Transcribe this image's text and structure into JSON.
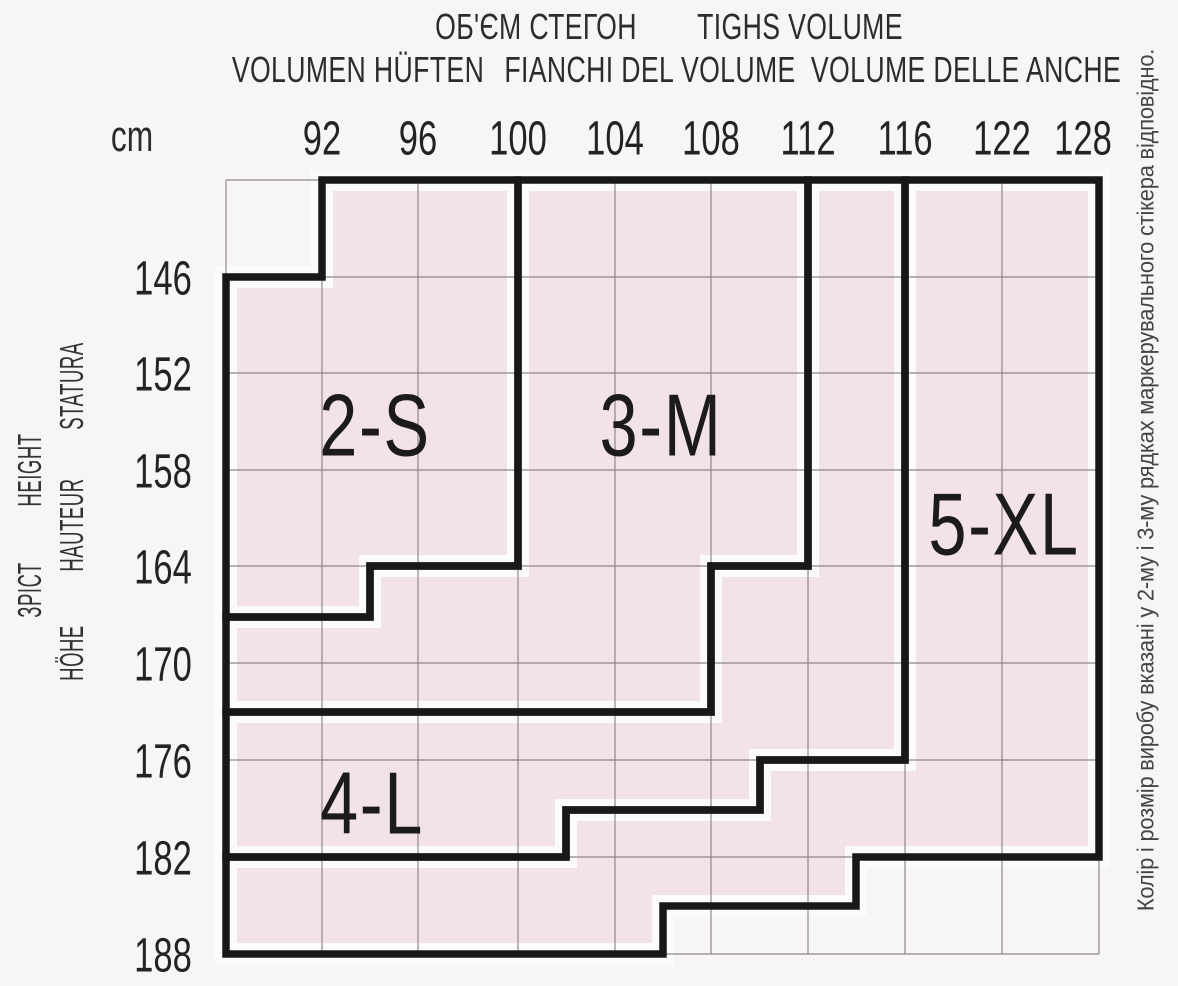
{
  "header": {
    "row1": [
      "ОБ'ЄМ СТЕГОН",
      "TIGHS VOLUME"
    ],
    "row2": [
      "VOLUMEN HÜFTEN",
      "FIANCHI DEL VOLUME",
      "VOLUME DELLE ANCHE"
    ],
    "unit_label": "cm"
  },
  "left_axis_titles": [
    "STATURA",
    "HEIGHT",
    "HAUTEUR",
    "ЗРІСТ",
    "HÖHE"
  ],
  "side_note": "Колір і розмір виробу вказані у 2-му і 3-му рядках маркерувального стікера відповідно.",
  "chart_data": {
    "type": "area",
    "title": "ОБ'ЄМ СТЕГОН / TIGHS VOLUME — hosiery size regions",
    "xlabel": "hip volume, cm",
    "ylabel": "height (зріст), cm",
    "x_ticks": [
      "92",
      "96",
      "100",
      "104",
      "108",
      "112",
      "116",
      "122",
      "128"
    ],
    "y_ticks": [
      "146",
      "152",
      "158",
      "164",
      "170",
      "176",
      "182",
      "188"
    ],
    "grid": true,
    "legend_position": "none",
    "units_note": "polygon_units are [hip_cm, height_cm]; 88 and 140 stand for the unlabeled left/top chart borders; half-step values (94,102,106,110,114 / 167,173,179,185) are mid-cell boundary steps",
    "grid_x_px": [
      226,
      322,
      418,
      518,
      615,
      711,
      808,
      905,
      1002,
      1099
    ],
    "grid_y_px": [
      180,
      277,
      373,
      470,
      566,
      663,
      760,
      857,
      954
    ],
    "x_tick_label_px": [
      322,
      418,
      518,
      615,
      711,
      808,
      905,
      1002,
      1083
    ],
    "y_tick_label_px": [
      277,
      373,
      470,
      566,
      663,
      760,
      857,
      954
    ],
    "regions": [
      {
        "label": "2-S",
        "label_px": [
          375,
          424
        ],
        "polygon_px": [
          [
            322,
            180
          ],
          [
            518,
            180
          ],
          [
            518,
            566
          ],
          [
            370,
            566
          ],
          [
            370,
            617
          ],
          [
            226,
            617
          ],
          [
            226,
            277
          ],
          [
            322,
            277
          ]
        ],
        "polygon_units": [
          [
            92,
            140
          ],
          [
            100,
            140
          ],
          [
            100,
            164
          ],
          [
            94,
            164
          ],
          [
            94,
            167
          ],
          [
            88,
            167
          ],
          [
            88,
            146
          ],
          [
            92,
            146
          ]
        ]
      },
      {
        "label": "3-M",
        "label_px": [
          661,
          424
        ],
        "polygon_px": [
          [
            518,
            180
          ],
          [
            808,
            180
          ],
          [
            808,
            566
          ],
          [
            711,
            566
          ],
          [
            711,
            712
          ],
          [
            226,
            712
          ],
          [
            226,
            617
          ],
          [
            370,
            617
          ],
          [
            370,
            566
          ],
          [
            518,
            566
          ]
        ],
        "polygon_units": [
          [
            100,
            140
          ],
          [
            112,
            140
          ],
          [
            112,
            164
          ],
          [
            108,
            164
          ],
          [
            108,
            173
          ],
          [
            88,
            173
          ],
          [
            88,
            167
          ],
          [
            94,
            167
          ],
          [
            94,
            164
          ],
          [
            100,
            164
          ]
        ]
      },
      {
        "label": "4-L",
        "label_px": [
          372,
          802
        ],
        "polygon_px": [
          [
            808,
            180
          ],
          [
            905,
            180
          ],
          [
            905,
            760
          ],
          [
            760,
            760
          ],
          [
            760,
            810
          ],
          [
            566,
            810
          ],
          [
            566,
            857
          ],
          [
            226,
            857
          ],
          [
            226,
            712
          ],
          [
            711,
            712
          ],
          [
            711,
            566
          ],
          [
            808,
            566
          ]
        ],
        "polygon_units": [
          [
            112,
            140
          ],
          [
            116,
            140
          ],
          [
            116,
            176
          ],
          [
            110,
            176
          ],
          [
            110,
            179
          ],
          [
            102,
            179
          ],
          [
            102,
            182
          ],
          [
            88,
            182
          ],
          [
            88,
            173
          ],
          [
            108,
            173
          ],
          [
            108,
            164
          ],
          [
            112,
            164
          ]
        ]
      },
      {
        "label": "5-XL",
        "label_px": [
          1004,
          523
        ],
        "polygon_px": [
          [
            905,
            180
          ],
          [
            1099,
            180
          ],
          [
            1099,
            857
          ],
          [
            856,
            857
          ],
          [
            856,
            906
          ],
          [
            663,
            906
          ],
          [
            663,
            954
          ],
          [
            226,
            954
          ],
          [
            226,
            857
          ],
          [
            566,
            857
          ],
          [
            566,
            810
          ],
          [
            760,
            810
          ],
          [
            760,
            760
          ],
          [
            905,
            760
          ]
        ],
        "polygon_units": [
          [
            116,
            140
          ],
          [
            128,
            140
          ],
          [
            128,
            182
          ],
          [
            114,
            182
          ],
          [
            114,
            185
          ],
          [
            106,
            185
          ],
          [
            106,
            188
          ],
          [
            88,
            188
          ],
          [
            88,
            182
          ],
          [
            102,
            182
          ],
          [
            102,
            179
          ],
          [
            110,
            179
          ],
          [
            110,
            176
          ],
          [
            116,
            176
          ]
        ]
      }
    ],
    "colors": {
      "background": "#f7f5f5",
      "region_fill": "#f3e2e6",
      "inset_margin": "#fcfbfb",
      "thin_grid": "#8a8186",
      "thick_border": "#191819",
      "tick_text": "#242224",
      "region_label_text": "#1c1b1c"
    }
  }
}
